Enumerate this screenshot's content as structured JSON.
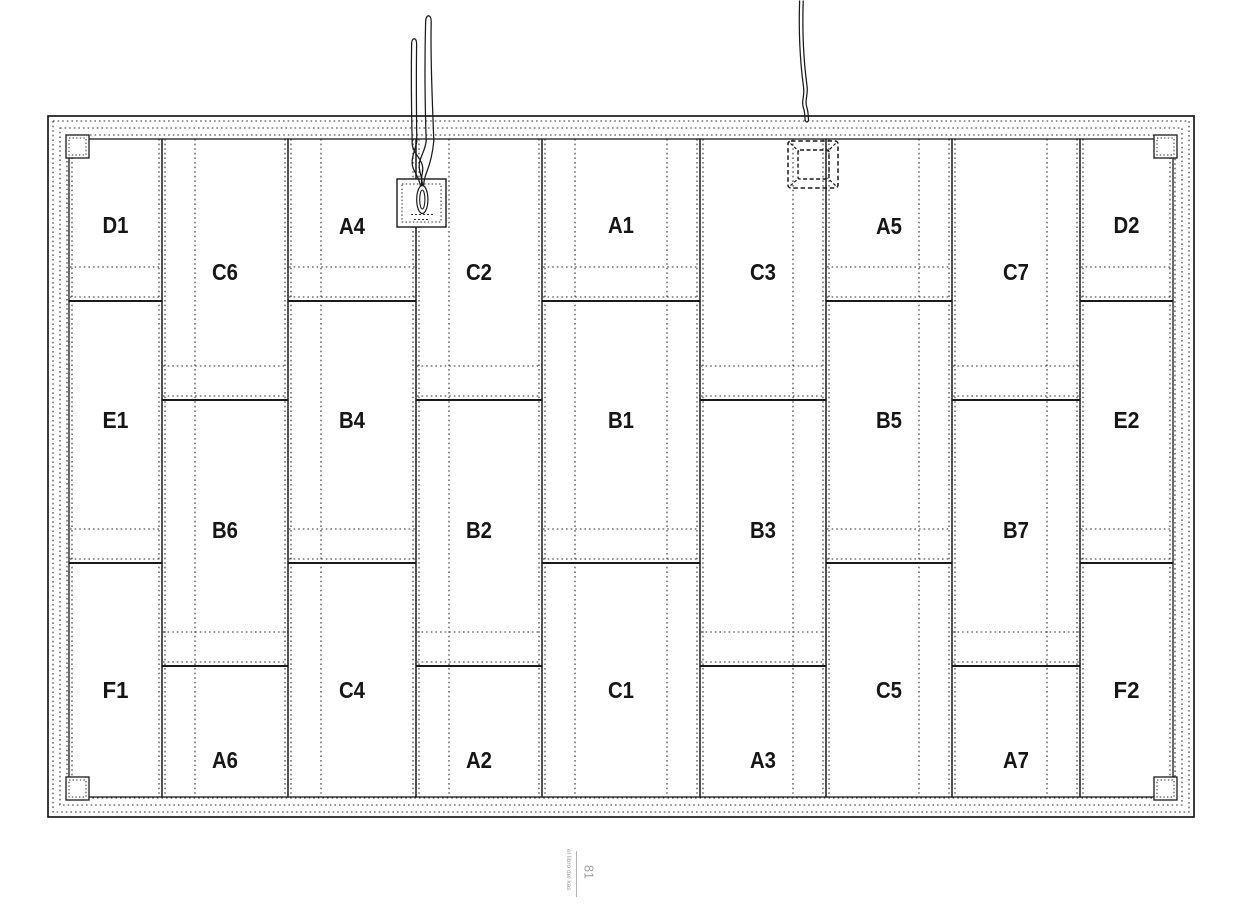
{
  "footer": {
    "book_title": "el libro del kas",
    "page_number": "81"
  },
  "diagram": {
    "canvas": {
      "w": 1256,
      "h": 904,
      "background": "#ffffff"
    },
    "colors": {
      "line": "#1a1a1a",
      "dotted": "#2e2e2e",
      "label": "#161616",
      "white": "#ffffff",
      "footer_text": "#a0a0a0",
      "footer_line": "#b4b4b4"
    },
    "frame": {
      "x": 48,
      "y": 116,
      "w": 1146,
      "h": 701,
      "dotted_insets": [
        5,
        12,
        19
      ]
    },
    "panel_area": {
      "x0": 69,
      "y0": 139,
      "x1": 1173,
      "y1": 797
    },
    "columns": [
      {
        "x0": 69,
        "x1": 162,
        "joints": [
          301,
          563
        ],
        "panels": [
          {
            "label": "D1",
            "label_y": 225
          },
          {
            "label": "E1",
            "label_y": 420
          },
          {
            "label": "F1",
            "label_y": 690
          }
        ]
      },
      {
        "x0": 162,
        "x1": 288,
        "joints": [
          400,
          666
        ],
        "panels": [
          {
            "label": "C6",
            "label_y": 272
          },
          {
            "label": "B6",
            "label_y": 530
          },
          {
            "label": "A6",
            "label_y": 760
          }
        ]
      },
      {
        "x0": 288,
        "x1": 416,
        "joints": [
          301,
          563
        ],
        "panels": [
          {
            "label": "A4",
            "label_y": 226
          },
          {
            "label": "B4",
            "label_y": 420
          },
          {
            "label": "C4",
            "label_y": 690
          }
        ]
      },
      {
        "x0": 416,
        "x1": 542,
        "joints": [
          400,
          666
        ],
        "panels": [
          {
            "label": "C2",
            "label_y": 272
          },
          {
            "label": "B2",
            "label_y": 530
          },
          {
            "label": "A2",
            "label_y": 760
          }
        ]
      },
      {
        "x0": 542,
        "x1": 700,
        "joints": [
          301,
          563
        ],
        "panels": [
          {
            "label": "A1",
            "label_y": 225
          },
          {
            "label": "B1",
            "label_y": 420
          },
          {
            "label": "C1",
            "label_y": 690
          }
        ]
      },
      {
        "x0": 700,
        "x1": 826,
        "joints": [
          400,
          666
        ],
        "panels": [
          {
            "label": "C3",
            "label_y": 272
          },
          {
            "label": "B3",
            "label_y": 530
          },
          {
            "label": "A3",
            "label_y": 760
          }
        ]
      },
      {
        "x0": 826,
        "x1": 952,
        "joints": [
          301,
          563
        ],
        "panels": [
          {
            "label": "A5",
            "label_y": 226
          },
          {
            "label": "B5",
            "label_y": 420
          },
          {
            "label": "C5",
            "label_y": 690
          }
        ]
      },
      {
        "x0": 952,
        "x1": 1080,
        "joints": [
          400,
          666
        ],
        "panels": [
          {
            "label": "C7",
            "label_y": 272
          },
          {
            "label": "B7",
            "label_y": 530
          },
          {
            "label": "A7",
            "label_y": 760
          }
        ]
      },
      {
        "x0": 1080,
        "x1": 1173,
        "joints": [
          301,
          563
        ],
        "panels": [
          {
            "label": "D2",
            "label_y": 225
          },
          {
            "label": "E2",
            "label_y": 420
          },
          {
            "label": "F2",
            "label_y": 690
          }
        ]
      }
    ],
    "vertical_battens": [
      72,
      159,
      165,
      195,
      285,
      291,
      321,
      413,
      419,
      449,
      539,
      545,
      575,
      667,
      697,
      703,
      793,
      823,
      829,
      919,
      949,
      955,
      1047,
      1077,
      1083,
      1170
    ],
    "joint_band_offsets": [
      34,
      4
    ],
    "corner_squares": {
      "size": 23,
      "inset": 3,
      "positions": [
        [
          66,
          135
        ],
        [
          1154,
          135
        ],
        [
          66,
          777
        ],
        [
          1154,
          777
        ]
      ]
    },
    "connection_box": {
      "x": 397,
      "y": 179,
      "w": 49,
      "h": 48,
      "inner_inset": 5,
      "terminal": {
        "cx": 422.3,
        "cy": 199.5,
        "rx": 5.6,
        "ry": 14,
        "inner_rx": 2.6,
        "inner_ry": 9.5
      },
      "marks": [
        [
          411,
          214.5,
          433
        ],
        [
          414,
          219.5,
          430
        ]
      ]
    },
    "back_box": {
      "x": 788,
      "y": 141,
      "w": 50,
      "h": 47,
      "inner": {
        "x": 798,
        "y": 150,
        "w": 31,
        "h": 29
      },
      "diagonals": [
        [
          790.5,
          143.5,
          799,
          151.5
        ],
        [
          835.5,
          143.5,
          827.5,
          151.5
        ],
        [
          790.5,
          185.5,
          799,
          178
        ],
        [
          835.5,
          185.5,
          827.5,
          178
        ]
      ]
    },
    "wires": {
      "strands": [
        "M412.2,141 C411.3,105 411.2,70 411.6,45 Q411.7,38.8 414.2,38.8 Q416.7,38.8 416.6,45 C416.2,75 416.4,110 416.8,141",
        "M426.2,141 C425,105 424.6,60 425.6,22.5 Q425.8,16 428.6,15.8 Q431.4,16.2 431.2,23 C430.2,60 432.6,105 433.8,141",
        "M412.2,141 C411,154 425,159 422.5,172 C420.8,180 421.6,184 421.8,187.5",
        "M416.8,141 C415.5,151 408.5,161 414.5,171 C417.5,176.5 420,182 420.8,187.5",
        "M426.2,141 C424.8,154 417,159 419.8,171 C421.8,179 422.6,183 422.8,187.5",
        "M433.8,141 C432.6,154 430,164 426.4,173 C423.8,179.5 423.6,184 423.4,187.5",
        "M799.6,1 C798.6,32 800.2,62 803.4,86 C805.2,96.5 800.8,100.5 803.6,108.5 C805.2,113.5 804.6,117 805.2,120.5",
        "M803.2,1 C802.2,32 803.8,62 806.9,85 C808.6,95 804.2,100 807,108 C808.6,113 808,117 808.6,120.5",
        "M805.2,120.5 Q806.9,123.5 808.6,120.5"
      ]
    }
  }
}
